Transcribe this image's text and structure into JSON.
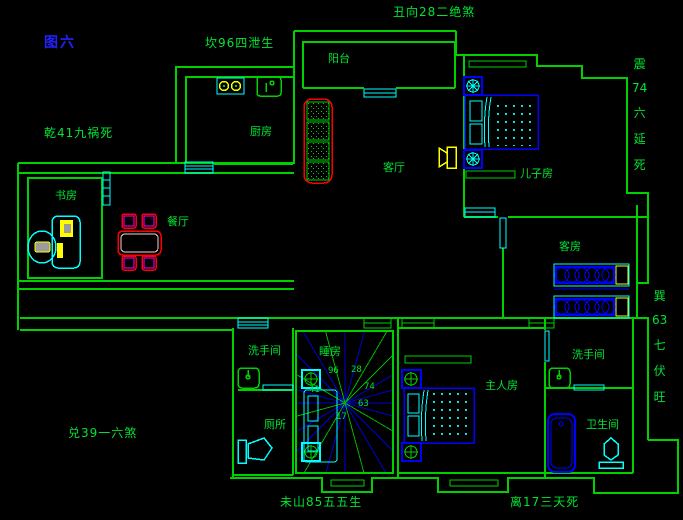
{
  "figure": {
    "title": "图六",
    "type": "feng-shui floor plan (CAD drawing, black background)"
  },
  "annotations": {
    "north": "坎96四泄生",
    "northeast": "丑向28二绝煞",
    "northwest": "乾41九祸死",
    "east_vertical": [
      "震",
      "74",
      "六",
      "延",
      "死"
    ],
    "southeast_vertical": [
      "巽",
      "63",
      "七",
      "伏",
      "旺"
    ],
    "southwest": "兑39一六煞",
    "south_left": "未山85五五生",
    "south_right": "离17三天死"
  },
  "rooms": {
    "balcony": "阳台",
    "kitchen": "厨房",
    "living": "客厅",
    "son": "儿子房",
    "study": "书房",
    "dining": "餐厅",
    "guest": "客房",
    "washroom_left": "洗手间",
    "washroom_right": "洗手间",
    "toilet": "厕所",
    "bathroom": "卫生间",
    "master": "主人房",
    "sleep": "睡房"
  },
  "compass": {
    "numbers": [
      {
        "value": "96"
      },
      {
        "value": "28"
      },
      {
        "value": "41"
      },
      {
        "value": "74"
      },
      {
        "value": "17"
      },
      {
        "value": "63"
      }
    ]
  },
  "colors": {
    "background": "#000000",
    "wall_green": "#00cf00",
    "text_green": "#00e432",
    "title_blue": "#2222ff",
    "furniture_blue": "#0000ff",
    "fixture_cyan": "#00ffff",
    "accent_yellow": "#ffff00",
    "accent_red": "#ff0000",
    "accent_magenta": "#ff00ff"
  }
}
